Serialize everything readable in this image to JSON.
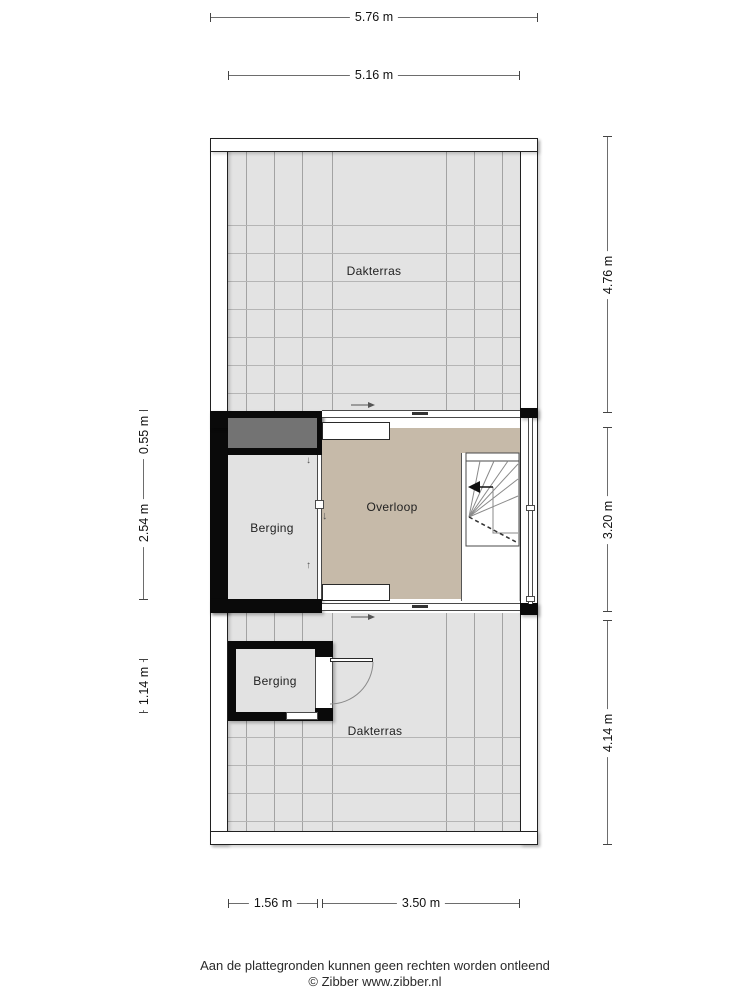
{
  "title": "Floor plan",
  "rooms": {
    "dakterras_top": "Dakterras",
    "berging_mid": "Berging",
    "overloop": "Overloop",
    "berging_bottom": "Berging",
    "dakterras_bottom": "Dakterras"
  },
  "dimensions": {
    "top_outer": "5.76 m",
    "top_inner": "5.16 m",
    "right_top": "4.76 m",
    "right_middle": "3.20 m",
    "right_bottom": "4.14 m",
    "left_top": "0.55 m",
    "left_middle": "2.54 m",
    "left_bottom": "1.14 m",
    "bottom_left": "1.56 m",
    "bottom_right": "3.50 m"
  },
  "footer": {
    "disclaimer": "Aan de plattegronden kunnen geen rechten worden ontleend",
    "credit": "© Zibber www.zibber.nl"
  },
  "icons": {
    "entry_arrow_top": "right-arrow",
    "entry_arrow_bottom": "right-arrow",
    "stair_direction": "left-arrowhead",
    "wall_arrow_down_1": "down-arrow",
    "wall_arrow_down_2": "down-arrow",
    "wall_arrow_up_1": "up-arrow"
  },
  "colors": {
    "terrace_floor": "#e3e3e3",
    "room_floor": "#e2e2e2",
    "overloop_floor": "#c6baa9",
    "flat_roof": "#737373",
    "wall": "#0a0a0a",
    "dimension_line": "#6d6d6d"
  }
}
